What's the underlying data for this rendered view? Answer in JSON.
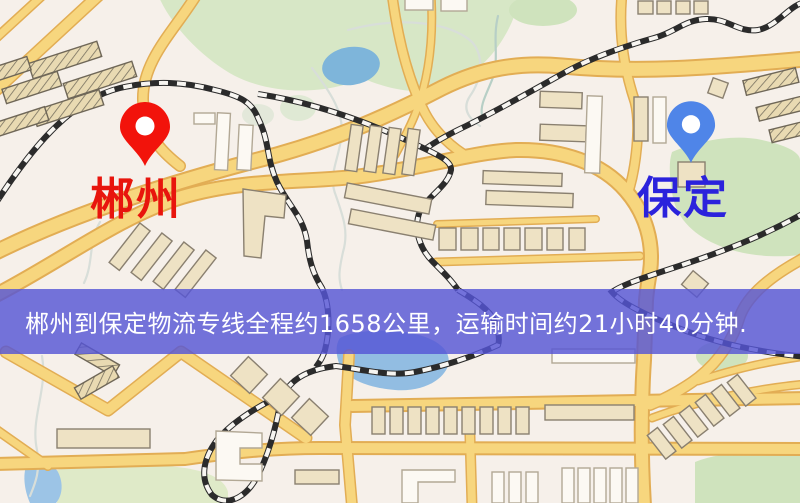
{
  "map": {
    "origin": {
      "label": "郴州",
      "pin_color": "#f2130b"
    },
    "destination": {
      "label": "保定",
      "pin_color": "#4f85e8"
    }
  },
  "banner": {
    "text": "郴州到保定物流专线全程约1658公里，运输时间约21小时40分钟.",
    "background": "#5555d6",
    "text_color": "#ffffff"
  },
  "icons": [
    {
      "name": "origin-pin-icon",
      "shape": "map-marker",
      "color": "#f2130b"
    },
    {
      "name": "destination-pin-icon",
      "shape": "map-marker",
      "color": "#4f85e8"
    }
  ],
  "colors": {
    "map_background": "#f6f0ea",
    "road_fill": "#f7d67e",
    "road_casing": "#e2ad54",
    "railway_dark": "#2b2b2b",
    "water": "#92bde2",
    "park_green": "#d7e7c6",
    "building_tan": "#eee2c4",
    "building_white": "#fcf9f3",
    "origin_text": "#e8150d",
    "destination_text": "#2b22dc"
  }
}
